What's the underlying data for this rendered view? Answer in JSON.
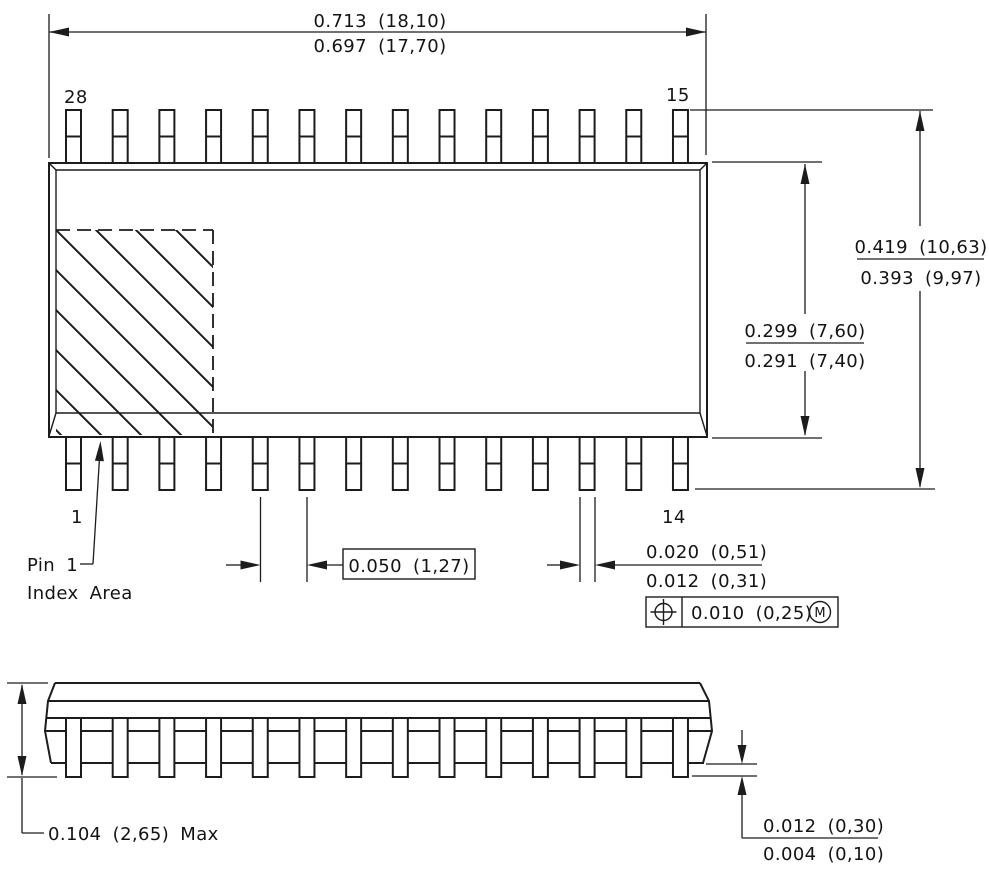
{
  "figure": {
    "type": "ic-package-outline-drawing",
    "views": [
      "top-view",
      "side-view"
    ],
    "pins_per_row": 14
  },
  "colors": {
    "line": "#1c1c1c",
    "background": "#ffffff"
  },
  "top_view": {
    "pin_labels": {
      "top_left": "28",
      "top_right": "15",
      "bottom_left": "1",
      "bottom_right": "14"
    },
    "width_dim": {
      "max": "0.713 (18,10)",
      "min": "0.697 (17,70)"
    },
    "overall_span_dim": {
      "max": "0.419 (10,63)",
      "min": "0.393 (9,97)"
    },
    "body_depth_dim": {
      "max": "0.299 (7,60)",
      "min": "0.291 (7,40)"
    },
    "pitch_dim": "0.050 (1,27)",
    "lead_width_dim": {
      "max": "0.020 (0,51)",
      "min": "0.012 (0,31)"
    },
    "true_position": {
      "tolerance": "0.010 (0,25)",
      "modifier": "M"
    },
    "index_area_label": {
      "line1": "Pin 1",
      "line2": "Index Area"
    }
  },
  "side_view": {
    "max_height_dim": "0.104 (2,65) Max",
    "standoff_dim": {
      "max": "0.012 (0,30)",
      "min": "0.004 (0,10)"
    }
  }
}
